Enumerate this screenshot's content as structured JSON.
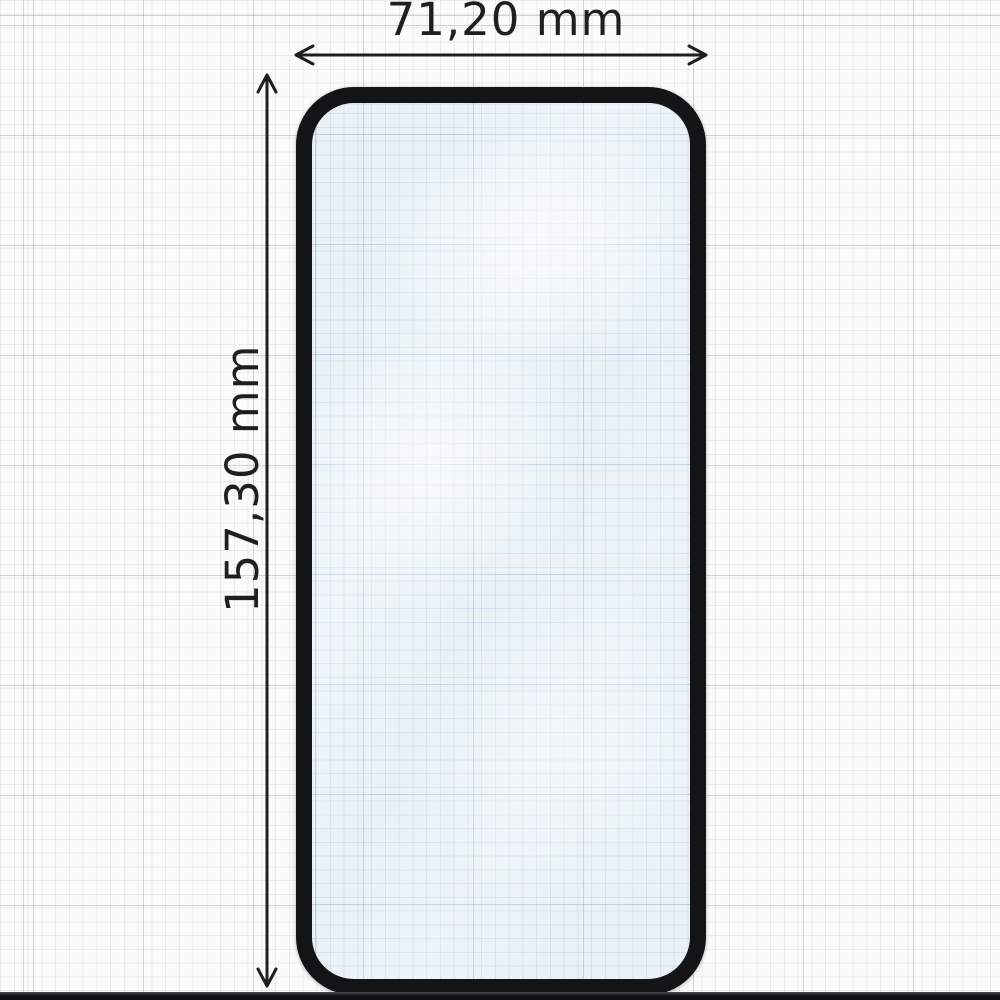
{
  "dimensions": {
    "width_label": "71,20 mm",
    "height_label": "157,30 mm"
  },
  "colors": {
    "paper": "#fbfbfa",
    "grid_minor": "#e9eaed",
    "grid_major": "#d8dade",
    "frame": "#141416",
    "glass_tint": "#e9f1f7",
    "glass_grid": "#c9dbe9",
    "annotation": "#1f1f22",
    "photo_edge_strip": "#101012"
  }
}
